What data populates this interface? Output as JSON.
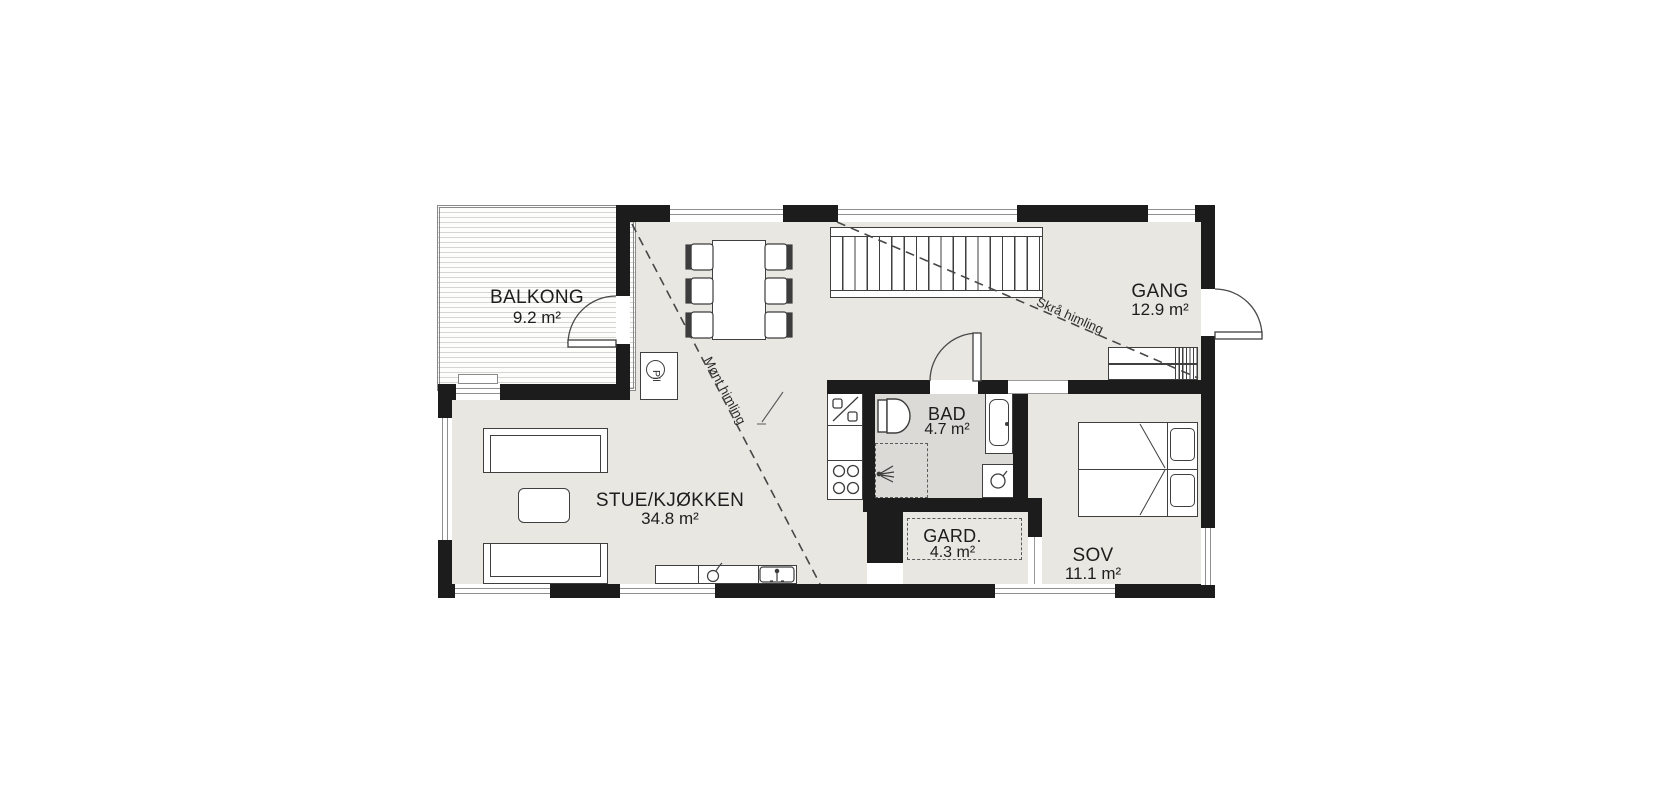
{
  "rooms": {
    "balkong": {
      "name": "BALKONG",
      "area": "9.2 m²"
    },
    "stue": {
      "name": "STUE/KJØKKEN",
      "area": "34.8 m²"
    },
    "gang": {
      "name": "GANG",
      "area": "12.9 m²"
    },
    "bad": {
      "name": "BAD",
      "area": "4.7 m²"
    },
    "gard": {
      "name": "GARD.",
      "area": "4.3 m²"
    },
    "sov": {
      "name": "SOV",
      "area": "11.1 m²"
    }
  },
  "annotations": {
    "ridge": "Mønt himling",
    "slope": "Skrå himling",
    "pipe": "Pil"
  },
  "colors": {
    "wall": "#1c1c1c",
    "floor": "#e9e7e2",
    "bath_floor": "#dbdad6",
    "line": "#3f3f3f",
    "deck_stripe": "#d6d5d1"
  }
}
